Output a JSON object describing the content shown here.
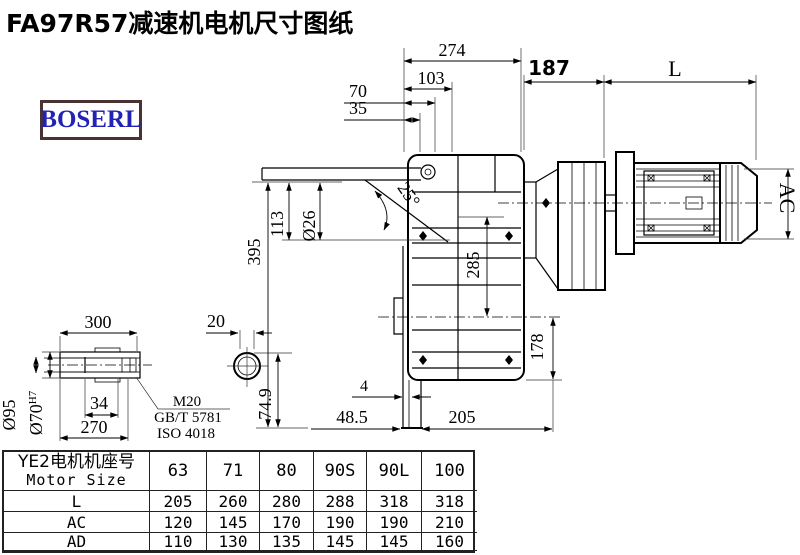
{
  "page": {
    "title": "FA97R57减速机电机尺寸图纸",
    "logo": "BOSERL"
  },
  "colors": {
    "logo_text": "#2222b4",
    "logo_border": "#4a3232",
    "drawing_line": "#000000"
  },
  "drawing": {
    "dims": {
      "w274": "274",
      "w103": "103",
      "w70": "70",
      "w35": "35",
      "w187": "187",
      "wL": "L",
      "h395": "395",
      "h113": "113",
      "dia26": "Ø26",
      "ang25": "25°",
      "h285": "285",
      "wAC": "AC",
      "h178": "178",
      "g4": "4",
      "g485": "48.5",
      "w205": "205",
      "w300": "300",
      "w20": "20",
      "dia95": "Ø95",
      "dia70": "Ø70",
      "dia70sup": "H7",
      "w34": "34",
      "w270": "270",
      "h749": "74.9",
      "thread1": "M20",
      "thread2": "GB/T 5781",
      "thread3": "ISO 4018"
    }
  },
  "table": {
    "header_cn": "YE2电机机座号",
    "header_en": "Motor Size",
    "sizes": [
      "63",
      "71",
      "80",
      "90S",
      "90L",
      "100"
    ],
    "rows": [
      {
        "label": "L",
        "values": [
          "205",
          "260",
          "280",
          "288",
          "318",
          "318"
        ]
      },
      {
        "label": "AC",
        "values": [
          "120",
          "145",
          "170",
          "190",
          "190",
          "210"
        ]
      },
      {
        "label": "AD",
        "values": [
          "110",
          "130",
          "135",
          "145",
          "145",
          "160"
        ]
      }
    ]
  }
}
